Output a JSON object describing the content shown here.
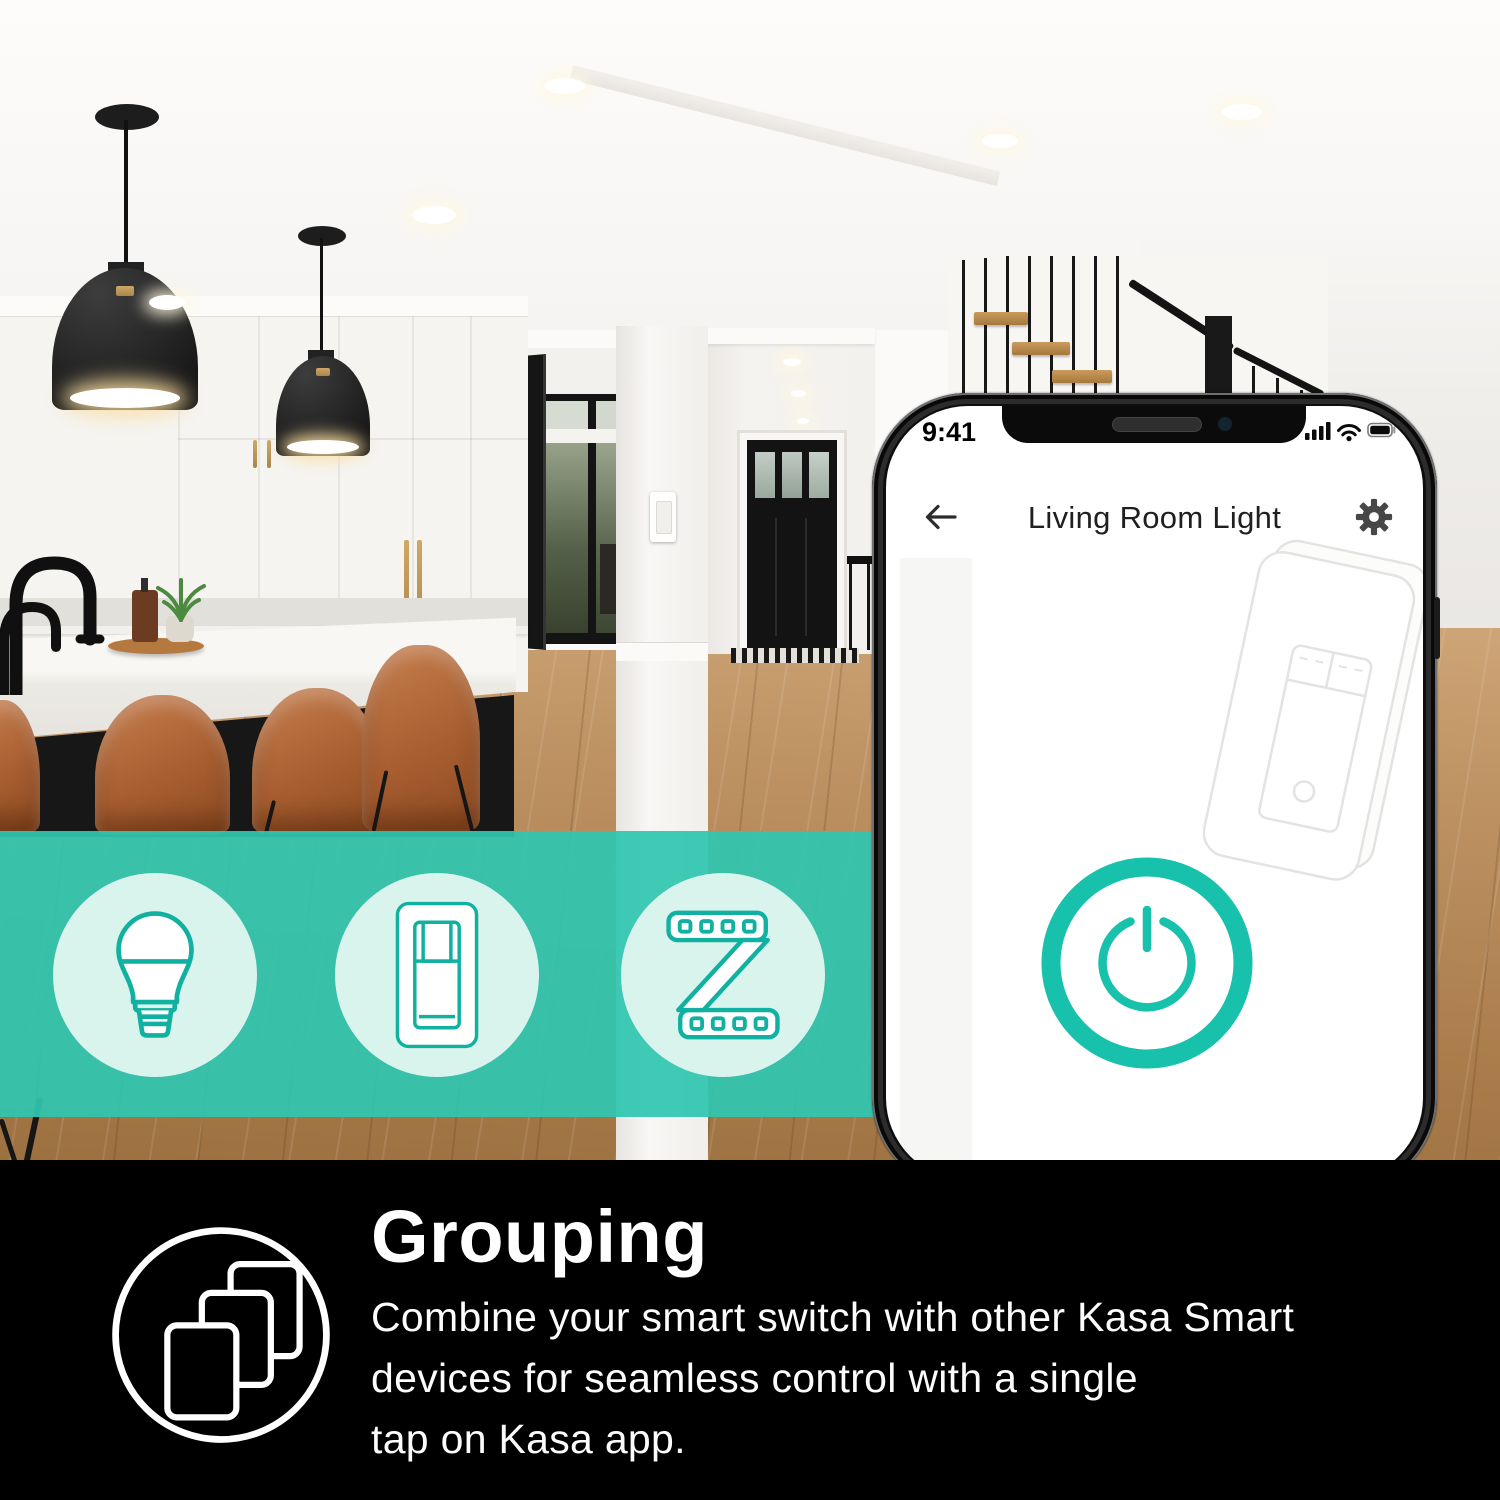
{
  "colors": {
    "accent_teal": "#17c1ab",
    "band_overlay": "#2fc6af",
    "feature_panel_bg": "#000000"
  },
  "phone": {
    "status_bar": {
      "time": "9:41",
      "icons": [
        "signal-bars-icon",
        "wifi-icon",
        "battery-icon"
      ]
    },
    "header": {
      "back_icon": "back-arrow-icon",
      "title": "Living Room Light",
      "settings_icon": "gear-icon"
    },
    "screen": {
      "illustration": "wall-switch-illustration",
      "power_icon": "power-icon"
    }
  },
  "category_band": {
    "icons": [
      "smart-bulb-icon",
      "smart-switch-icon",
      "led-strip-icon"
    ]
  },
  "feature": {
    "heading": "Grouping",
    "icon": "grouping-stack-icon",
    "lines": [
      "Combine your smart switch with other Kasa Smart",
      "devices for seamless control with a single",
      "tap on Kasa app."
    ]
  }
}
